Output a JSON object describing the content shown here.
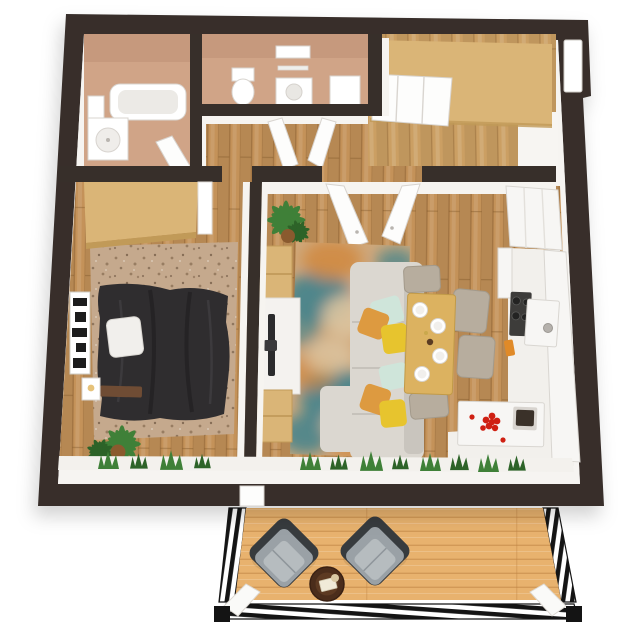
{
  "scene": {
    "description": "3D top-down floor plan render of a one-bedroom apartment with bathroom, toilet room, hallway, entry closet, bedroom, living-dining room, kitchen and a wooden balcony with two armchairs and a round table"
  },
  "rooms": [
    "bathroom",
    "toilet-room",
    "hallway",
    "entry-closet",
    "bedroom",
    "living-room",
    "kitchen",
    "balcony"
  ],
  "palette": {
    "wall": "#372f2a",
    "white_wall": "#f6f4f1",
    "tan_floor": "#d0a487",
    "tan_wall": "#bd8f74",
    "wood": "#c49259",
    "wood_seam": "#7a5226",
    "entry_wood": "#cb9f63",
    "deck": "#e8b26e",
    "deck_seam": "#bb8040",
    "wardrobe": "#dab577",
    "wardrobe_edge": "#c19a58",
    "bed_rug": "#c5a98d",
    "speck": "#8d7258",
    "rug_base": "#cfa87b",
    "teal": "#38808d",
    "orange": "#d0883f",
    "cream": "#dcc4a0",
    "pink": "#d3a794",
    "sofa": "#dbd7d0",
    "sofa_dark": "#c9c5be",
    "duvet": "#2f2d2f",
    "pillow": "#f1efec",
    "table": "#dcb260",
    "table_edge": "#c19a48",
    "chair": "#b7ad9e",
    "chair_edge": "#a39a8b",
    "counter": "#f7f6f4",
    "counter_edge": "#d9d6d1",
    "stove": "#3d3c3a",
    "red": "#cf2012",
    "yellow": "#e7c42e",
    "mint": "#cfe5da",
    "orange_pillow": "#dd9a40",
    "plant": "#3f8038",
    "plant_dark": "#2d6328",
    "pot": "#8a5a2e",
    "tv": "#2b2b2d",
    "console_white": "#f4f2ef",
    "railing": "#141414",
    "table_round": "#4b2d1b",
    "art_dark": "#1c1c1c",
    "door_white": "#fdfdfc",
    "jamb": "#d8d4cf"
  }
}
